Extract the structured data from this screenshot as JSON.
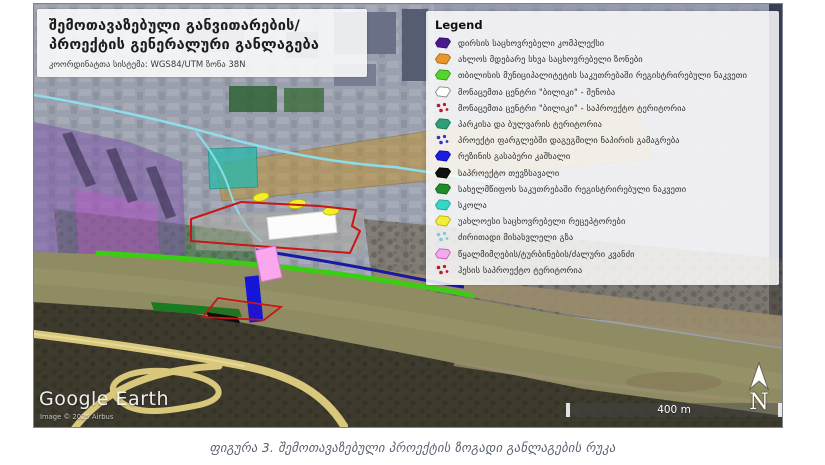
{
  "title_box": {
    "line1": "შემოთავაზებული განვითარების/",
    "line2": "პროექტის გენერალური განლაგება",
    "subtitle": "კოორდინატთა სისტემა: WGS84/UTM ზონა 38N"
  },
  "legend": {
    "title": "Legend",
    "items": [
      {
        "label": "დირსის საცხოვრებელი კომპლექსი",
        "icon": "polygon",
        "fill": "#4a1a8c",
        "stroke": "#33106b"
      },
      {
        "label": "ახლოს მდებარე სხვა საცხოვრებელი ზონები",
        "icon": "polygon",
        "fill": "#e8962e",
        "stroke": "#a86a10"
      },
      {
        "label": "თბილისის მუნიციპალიტეტის საკუთრებაში რეგისტრირებული ნაკვეთი",
        "icon": "polygon",
        "fill": "#55d42e",
        "stroke": "#2f9a12"
      },
      {
        "label": "მონაცემთა ცენტრი \"ბილიკი\" - შენობა",
        "icon": "polygon",
        "fill": "#ffffff",
        "stroke": "#8a8a8a"
      },
      {
        "label": "მონაცემთა ცენტრი \"ბილიკი\" - საპროექტო ტერიტორია",
        "icon": "dots",
        "fill": "#c01525"
      },
      {
        "label": "პარკისა და ბულვარის ტერიტორია",
        "icon": "polygon",
        "fill": "#2e9e78",
        "stroke": "#1a7a58"
      },
      {
        "label": "პროექტი ფარგლებში დაგეგმილი ნაპირის გამაგრება",
        "icon": "dots",
        "fill": "#2a35c8"
      },
      {
        "label": "რეზინის გასაბერი კაშხალი",
        "icon": "polygon",
        "fill": "#1c1ce0",
        "stroke": "#0d0da8"
      },
      {
        "label": "საპროექტო თევზსავალი",
        "icon": "polygon",
        "fill": "#101010",
        "stroke": "#000000"
      },
      {
        "label": "სახელმწიფოს საკუთრებაში რეგისტრირებული ნაკვეთი",
        "icon": "polygon",
        "fill": "#1e8c28",
        "stroke": "#11661a"
      },
      {
        "label": "სკოლა",
        "icon": "polygon",
        "fill": "#38d4c4",
        "stroke": "#18a898"
      },
      {
        "label": "უახლოესი საცხოვრებელი რეცეპტორები",
        "icon": "polygon",
        "fill": "#f2ee3a",
        "stroke": "#b8b410"
      },
      {
        "label": "ძირითადი მისასვლელი გზა",
        "icon": "dots",
        "fill": "#7cc8dc"
      },
      {
        "label": "წყალმიმღების/ტურბინების/ძალური კვანძი",
        "icon": "polygon",
        "fill": "#f2aaec",
        "stroke": "#c45ec0"
      },
      {
        "label": "ჰესის საპროექტო ტერიტორია",
        "icon": "dots",
        "fill": "#c01525"
      }
    ]
  },
  "map": {
    "watermark": "Google Earth",
    "attribution": "Image © 2025 Airbus",
    "scale_label": "400 m",
    "north_label": "N"
  },
  "caption": "ფიგურა 3. შემოთავაზებული პროექტის ზოგადი განლაგების რუკა"
}
